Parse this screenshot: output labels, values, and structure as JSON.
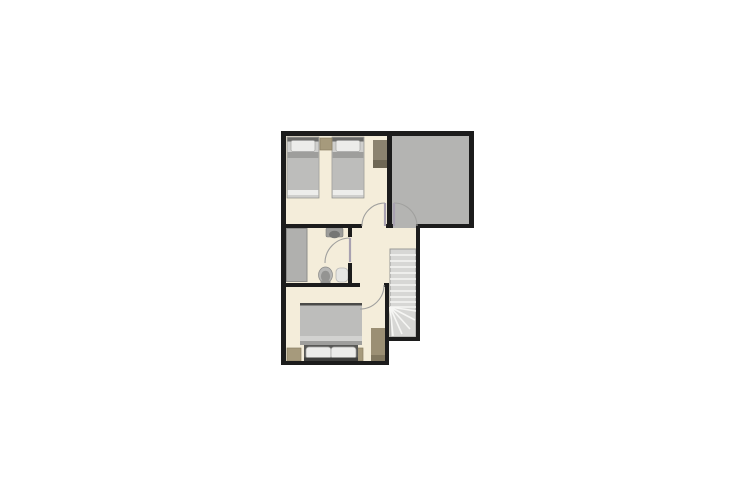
{
  "canvas": {
    "width": 755,
    "height": 504,
    "background": "#ffffff"
  },
  "plan": {
    "left": 281,
    "top": 131,
    "width": 193,
    "height": 234,
    "type": "floor-plan-upper-storey"
  },
  "palette": {
    "background": "#ffffff",
    "wall": "#1c1c1c",
    "floor": "#f4edda",
    "gray_area": "#b4b4b2",
    "shower": "#b0b0ae",
    "shower_border": "#8e8e8c",
    "stairs": "#d7d7d5",
    "stair_tread": "#f6f6f4",
    "stair_edge": "#9a9a98",
    "door_arc": "#a0a09e",
    "door_leaf": "#a8a1b0",
    "mattress": "#cfcfcd",
    "mattress_border": "#8d8d8b",
    "bed_blanket": "#bdbdbb",
    "bed_fold": "#9e9e9c",
    "bed_fold_light": "#d2d2d0",
    "bed_sheet": "#ededeb",
    "bed_base": "#585856",
    "bed_headboard": "#3e3e3c",
    "twin_headboard": "#6b6b69",
    "bed_frame": "#4a4a48",
    "pillow": "#ececea",
    "pillow_border": "#a3a3a1",
    "wardrobe": "#8b8370",
    "wardrobe_dark": "#6e6754",
    "wardrobe2": "#9b8f74",
    "wardrobe2_dark": "#81775f",
    "nightstand": "#a69a7c",
    "furniture_border": "#8a7f63",
    "toilet": "#b7b7b5",
    "toilet_border": "#8a8a88",
    "toilet_inner": "#949492",
    "sink": "#9c9c9a",
    "sink_border": "#7c7c7a",
    "sink_bowl": "#767674",
    "fixture": "#e6e6e3",
    "fixture_border": "#b7b7b5"
  },
  "rooms": [
    {
      "id": "twin-bedroom",
      "position": "top-left",
      "furniture": [
        "single-bed",
        "single-bed",
        "nightstand",
        "wardrobe"
      ],
      "doors": 1
    },
    {
      "id": "gray-open-area",
      "position": "top-right",
      "furniture": [],
      "doors": 1
    },
    {
      "id": "bathroom",
      "position": "middle-left",
      "fixtures": [
        "shower",
        "washbasin",
        "toilet",
        "white-fixture"
      ],
      "doors": 1
    },
    {
      "id": "hallway",
      "position": "middle-right",
      "features": [
        "staircase"
      ],
      "doors": 0
    },
    {
      "id": "double-bedroom",
      "position": "bottom",
      "furniture": [
        "double-bed",
        "nightstand",
        "nightstand",
        "wardrobe"
      ],
      "doors": 1
    }
  ],
  "stairs": {
    "straight_treads": 10,
    "winder_treads": 5,
    "direction": "vertical-run-with-bottom-winder"
  }
}
